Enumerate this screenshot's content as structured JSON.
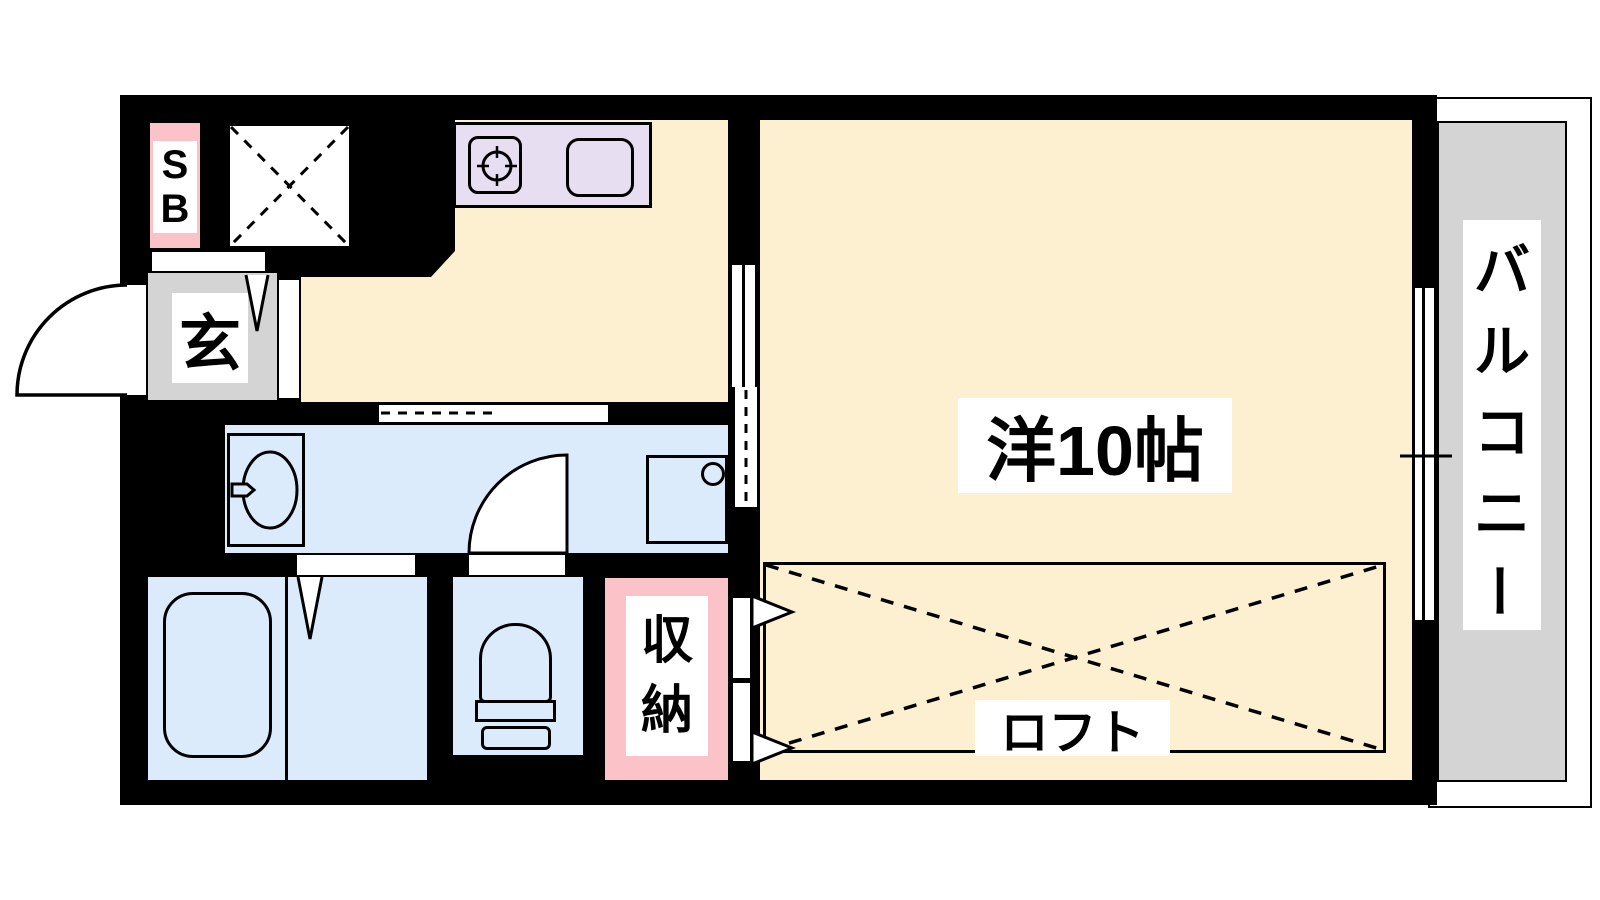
{
  "plan": {
    "type": "apartment-floor-plan",
    "labels": {
      "main_room": "洋10帖",
      "loft": "ロフト",
      "balcony": "バルコニー",
      "balcony_chars": [
        "バ",
        "ル",
        "コ",
        "ニ",
        "ー"
      ],
      "entrance": "玄",
      "shoe_box": "SB",
      "shoe_box_chars": [
        "S",
        "B"
      ],
      "storage": "収納",
      "storage_chars": [
        "収",
        "納"
      ]
    },
    "colors": {
      "wall_black": "#000000",
      "room_floor_cream": "#FCF0D1",
      "wet_area_blue": "#DCEBFC",
      "kitchen_counter_lavender": "#E7DEF2",
      "accent_pink": "#FBC3C7",
      "balcony_gray": "#D4D4D4"
    },
    "fixtures": [
      "stove",
      "kitchen-sink",
      "vanity-basin",
      "washing-machine-pan",
      "bathtub",
      "toilet",
      "entrance-door",
      "closet",
      "loft"
    ]
  }
}
